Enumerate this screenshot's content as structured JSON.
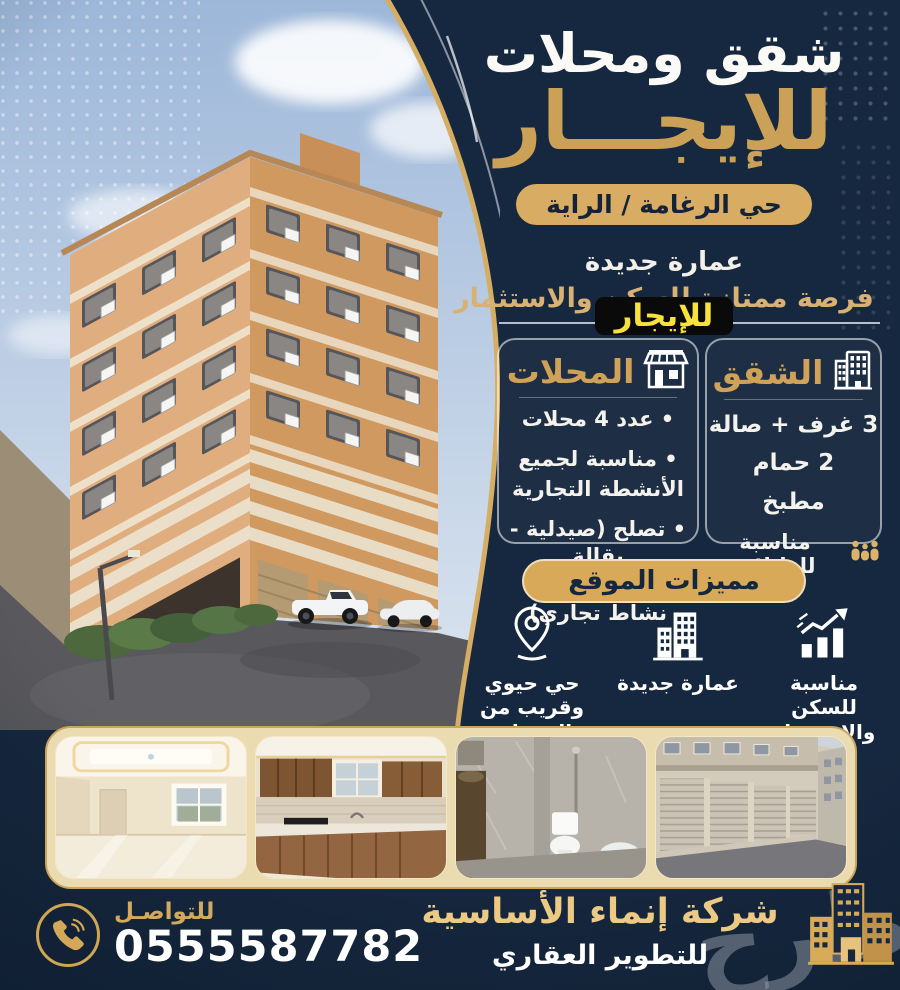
{
  "colors": {
    "navy": "#16283f",
    "gold": "#d8ad63",
    "gold_text": "#cba057",
    "yellow": "#f7e13c",
    "cream": "#eadbb0"
  },
  "header": {
    "title": "شقق ومحلات",
    "rent_title": "للإيجـــار",
    "location_badge": "حي الرغامة / الراية",
    "building_status": "عمارة جديدة",
    "opportunity": "فرصة ممتازة للسكن والاستثمار",
    "rent_tag": "للإيجار"
  },
  "shops_box": {
    "title": "المحلات",
    "lines": [
      "• عدد 4 محلات",
      "• مناسبة لجميع",
      "الأنشطة التجارية",
      "• تصلح (صيدلية - بقالة"
    ],
    "last_line": {
      "pre": "مغسلة",
      "or": "أو",
      "post": "اي نشاط تجاري)"
    }
  },
  "apartments_box": {
    "title": "الشقق",
    "items": [
      "3 غرف + صالة",
      "2 حمام",
      "مطبخ"
    ],
    "family_note": "مناسبة للعائلات"
  },
  "features": {
    "badge": "مميزات الموقع",
    "items": [
      {
        "icon": "growth-chart-icon",
        "label": "مناسبة للسكن والاستثمار"
      },
      {
        "icon": "building-icon",
        "label": "عمارة جديدة"
      },
      {
        "icon": "location-pin-icon",
        "label": "حي حيوي وقريب من الخدمات"
      }
    ]
  },
  "photos": [
    "living-room-photo",
    "kitchen-photo",
    "bathroom-photo",
    "shops-street-photo"
  ],
  "contact": {
    "label": "للتواصـل",
    "phone": "0555587782"
  },
  "company": {
    "name": "شركة إنماء الأساسية",
    "tagline": "للتطوير العقاري",
    "watermark": "طرح"
  }
}
